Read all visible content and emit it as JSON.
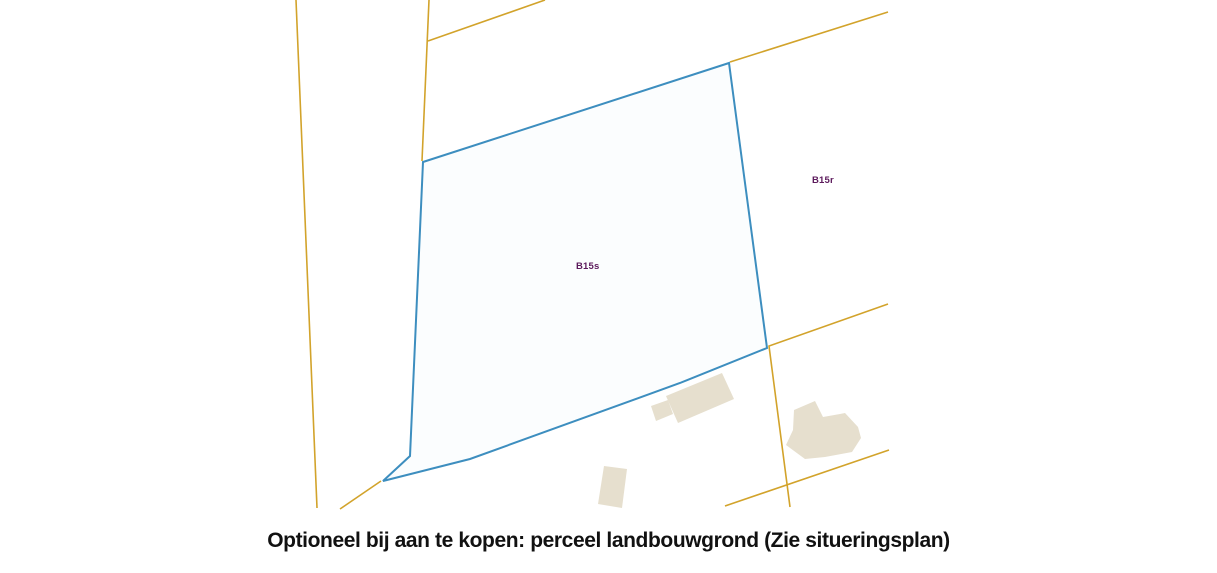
{
  "map": {
    "parcel_labels": {
      "b15s": "B15s",
      "b15r": "B15r"
    }
  },
  "caption": {
    "text": "Optioneel bij aan te kopen: perceel landbouwgrond (Zie situeringsplan)"
  },
  "colors": {
    "road-line": "#D2A32B",
    "parcel-outline": "#3D8EBF",
    "parcel-fill": "#FBFDFE",
    "building-fill": "#E6DFCE",
    "parcel-label": "#5C1A5C",
    "caption-text": "#111111",
    "background": "#FFFFFF"
  }
}
